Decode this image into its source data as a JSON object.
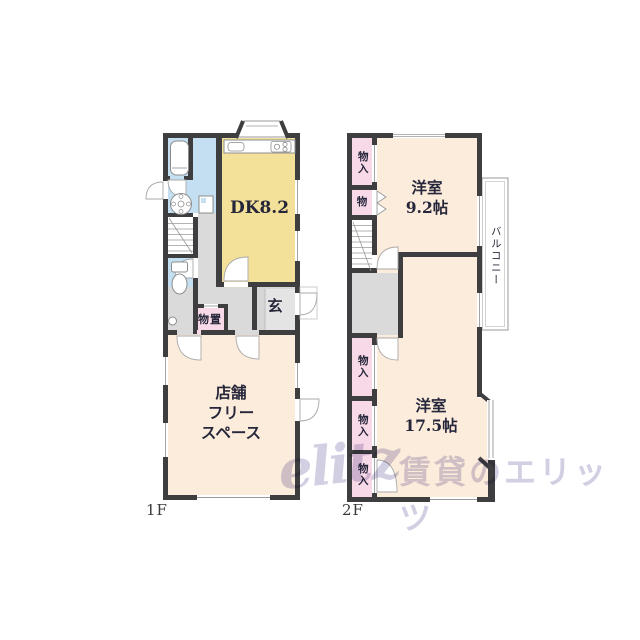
{
  "floor1": {
    "floor_label": "1F",
    "rooms": {
      "dk": "DK8.2",
      "entrance": "玄",
      "storage": "物置",
      "shop": "店舗\nフリー\nスペース"
    }
  },
  "floor2": {
    "floor_label": "2F",
    "rooms": {
      "western_9_2": "洋室\n9.2帖",
      "western_17_5": "洋室\n17.5帖",
      "balcony": "バルコニー",
      "closet_top": "物入",
      "closet_mini": "物",
      "closet_a": "物入",
      "closet_b": "物入",
      "closet_c": "物入"
    }
  },
  "watermark": {
    "logo": "elitz",
    "text": "賃貸のエリッツ"
  },
  "colors": {
    "wall": "#3e3d40",
    "room_cream": "#fcecdc",
    "room_yellow": "#f3e19a",
    "room_blue": "#c3dff1",
    "room_pink": "#f8d9e8",
    "floor_gray": "#dadada",
    "watermark": "#d2cfe3"
  }
}
